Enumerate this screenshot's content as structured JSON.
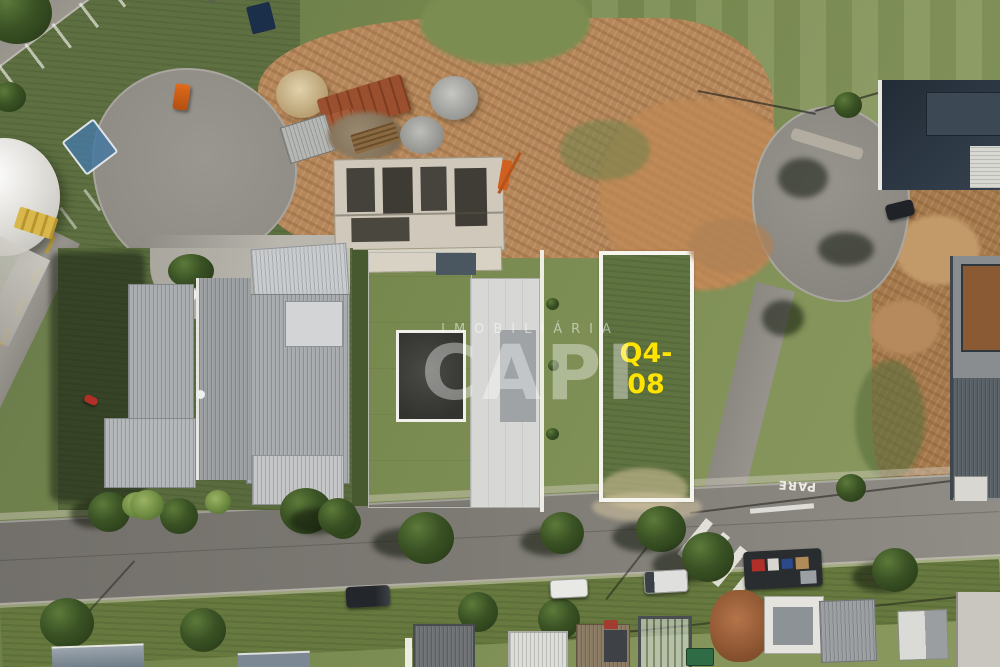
{
  "image": {
    "kind": "aerial-drone-photo-of-residential-lots",
    "watermark": {
      "line1": "IMOBILIÁRIA",
      "line2": "CAPI"
    },
    "lot": {
      "label": "Q4-08",
      "outline_color": "#f6f4ee",
      "label_color": "#ffe400"
    },
    "road_marking": {
      "text": "PARE",
      "color": "#eceae2"
    }
  }
}
